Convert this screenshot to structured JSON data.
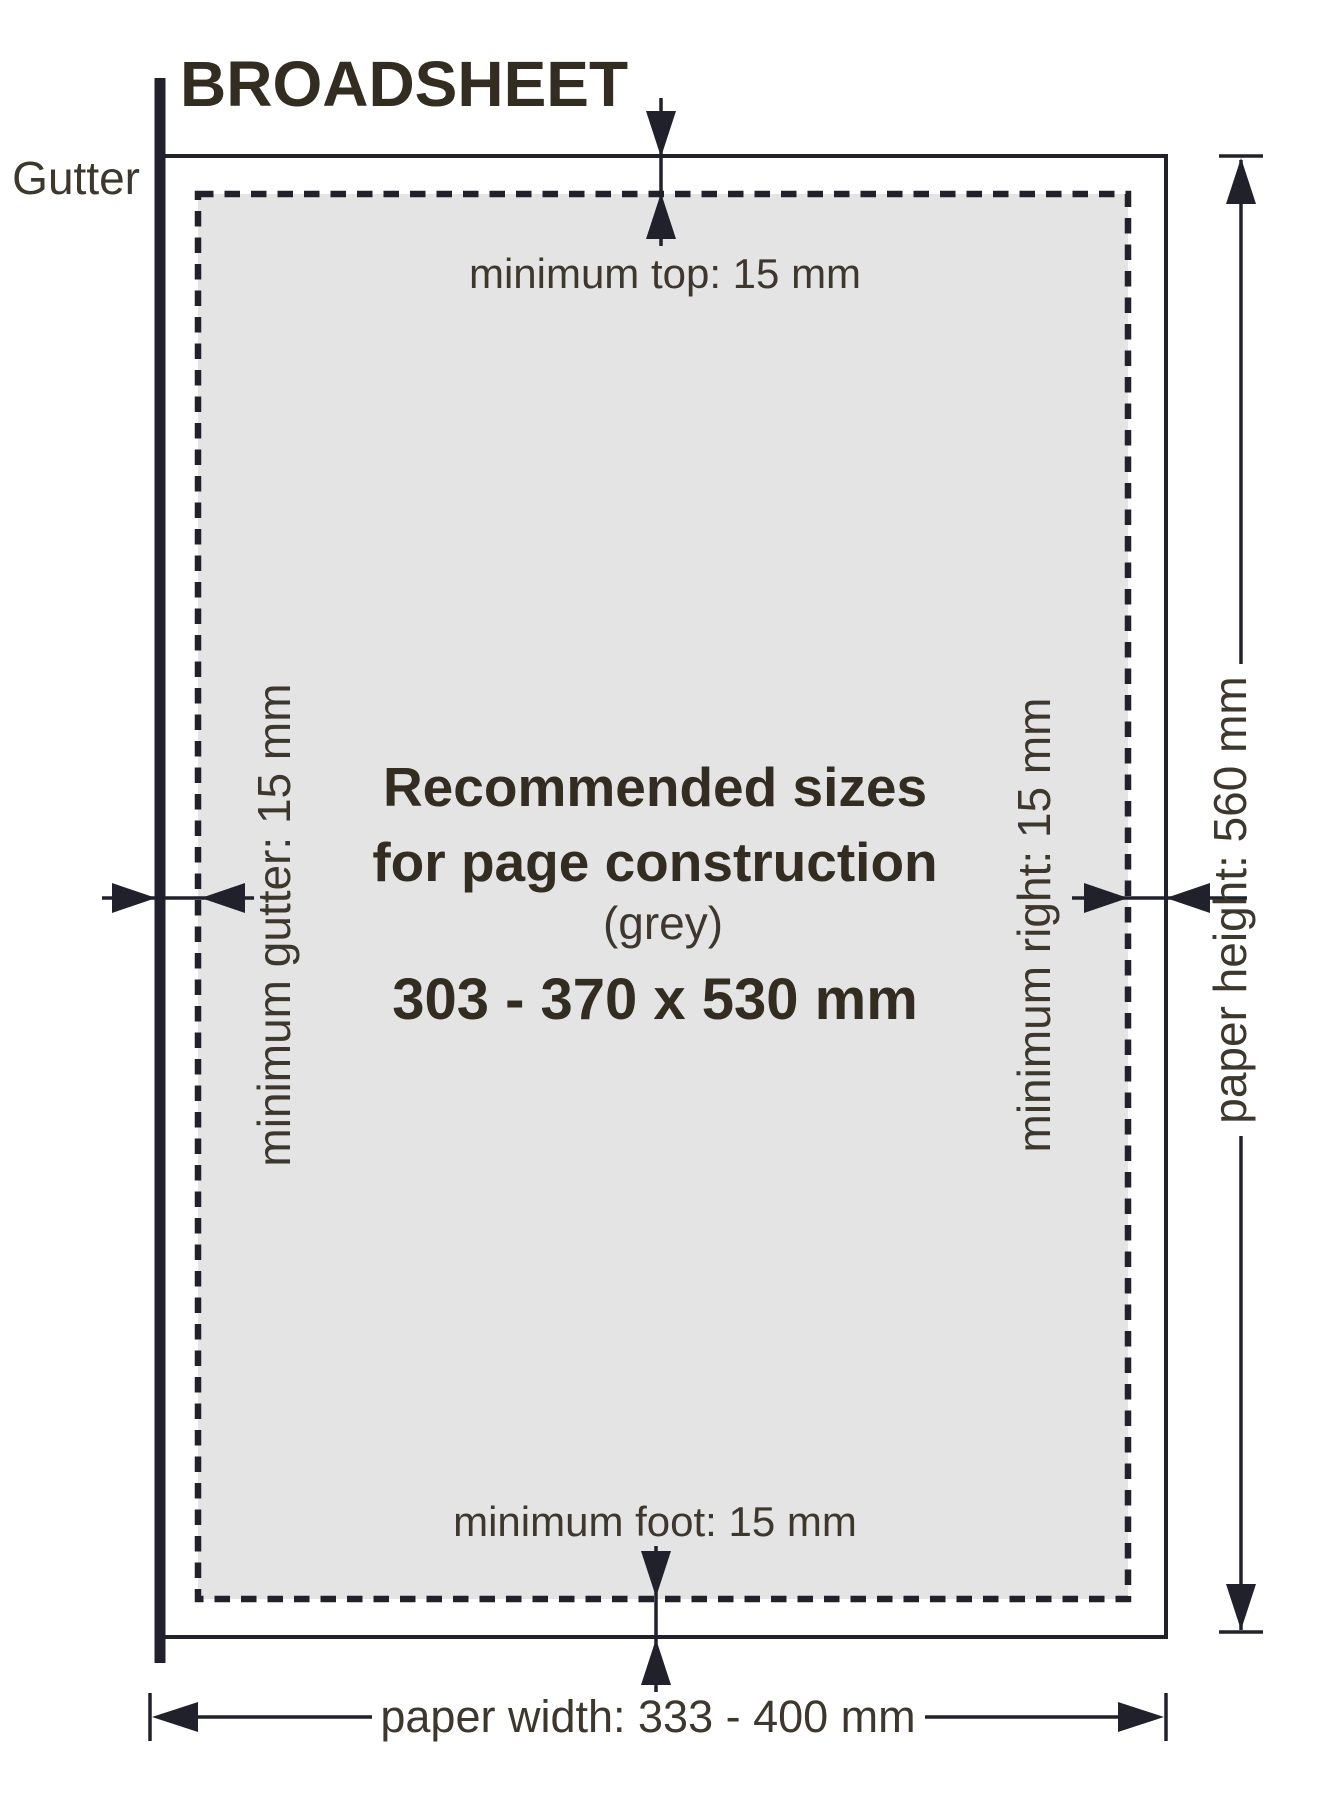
{
  "title": "BROADSHEET",
  "gutter_label": "Gutter",
  "page": {
    "center_line1": "Recommended sizes",
    "center_line2": "for page construction",
    "center_line3": "(grey)",
    "center_line4": "303 - 370 x 530 mm"
  },
  "dimensions": {
    "min_top": "minimum top: 15 mm",
    "min_gutter": "minimum gutter: 15 mm",
    "min_right": "minimum right: 15 mm",
    "min_foot": "minimum foot: 15 mm",
    "paper_width": "paper width: 333 - 400 mm",
    "paper_height": "paper height: 560 mm"
  },
  "colors": {
    "background": "#ffffff",
    "page_grey": "#e4e4e5",
    "ink": "#20212b",
    "label_text": "#3e372d",
    "title_text": "#332c20"
  }
}
